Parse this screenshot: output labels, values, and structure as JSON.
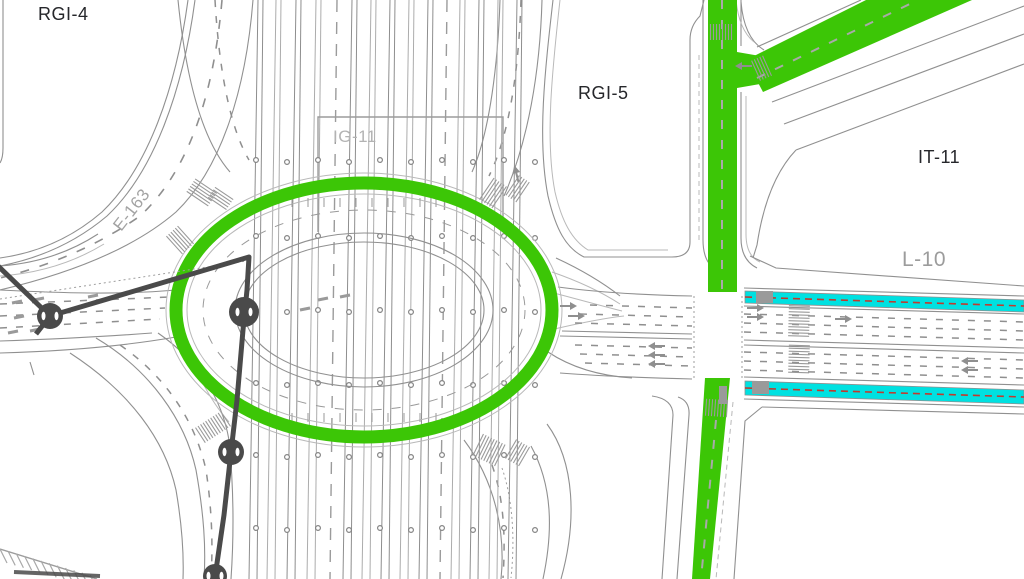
{
  "map": {
    "labels": {
      "rgi_4": "RGI-4",
      "rgi_5": "RGI-5",
      "it_11": "IT-11",
      "ig_11": "IG-11",
      "e_163": "E-163",
      "l_10": "L-10"
    },
    "colors": {
      "green_road": "#3CC606",
      "cycle_lane": "#00E1E1",
      "cycle_dash": "#C23A2E",
      "utility_line": "#4A4A4A",
      "road_edge": "#909090",
      "zone_label": "#26272B",
      "ref_label": "#A3A3A3"
    }
  }
}
